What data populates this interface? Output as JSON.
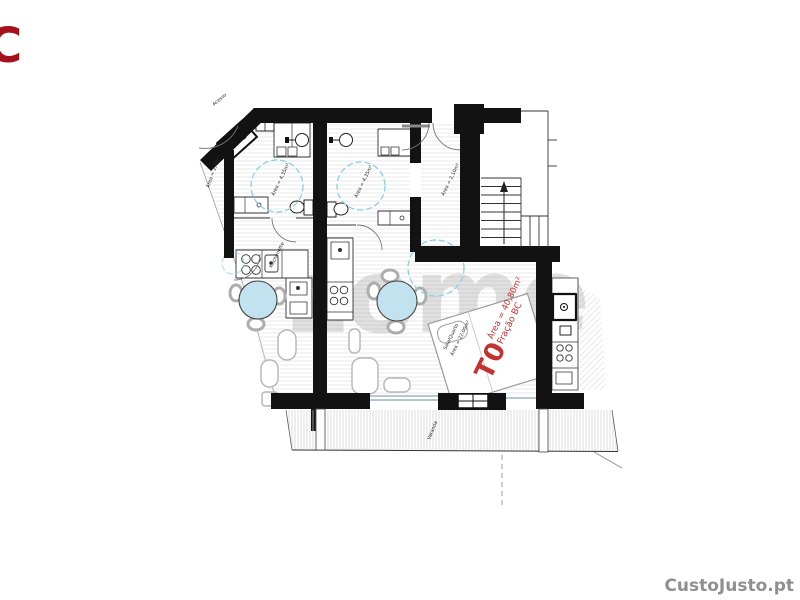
{
  "branding": {
    "corner_letter": "C",
    "corner_watermark": "CustoJusto.pt",
    "center_watermark": "zome"
  },
  "unit_label": {
    "type": "T0",
    "area": "Área = 40,80m²",
    "fraction": "Fração BC",
    "color": "#c5322e"
  },
  "annotations": [
    {
      "text": "Área = 4,35m²",
      "x": 274,
      "y": 196,
      "r": -64
    },
    {
      "text": "Área = 4,35m²",
      "x": 357,
      "y": 198,
      "r": -64
    },
    {
      "text": "Kitchenette",
      "x": 272,
      "y": 268,
      "r": -64
    },
    {
      "text": "Área = 2,10m²",
      "x": 444,
      "y": 196,
      "r": -64
    },
    {
      "text": "Sala/Quarto",
      "x": 446,
      "y": 350,
      "r": -64
    },
    {
      "text": "Área = 22,00m²",
      "x": 453,
      "y": 356,
      "r": -64
    },
    {
      "text": "Varanda",
      "x": 430,
      "y": 440,
      "r": -68
    },
    {
      "text": "Área = 2,40m²",
      "x": 209,
      "y": 188,
      "r": -70
    },
    {
      "text": "Acesso",
      "x": 214,
      "y": 106,
      "r": -40
    }
  ],
  "colors": {
    "wall": "#121212",
    "table_fill": "#c3e2f0",
    "dashed_circle": "#8ccfe4",
    "glazing": "#8aa4b8",
    "red_label": "#c5322e",
    "watermark_gray": "#9c9c9c",
    "corner_letter_red": "#a5121c"
  }
}
